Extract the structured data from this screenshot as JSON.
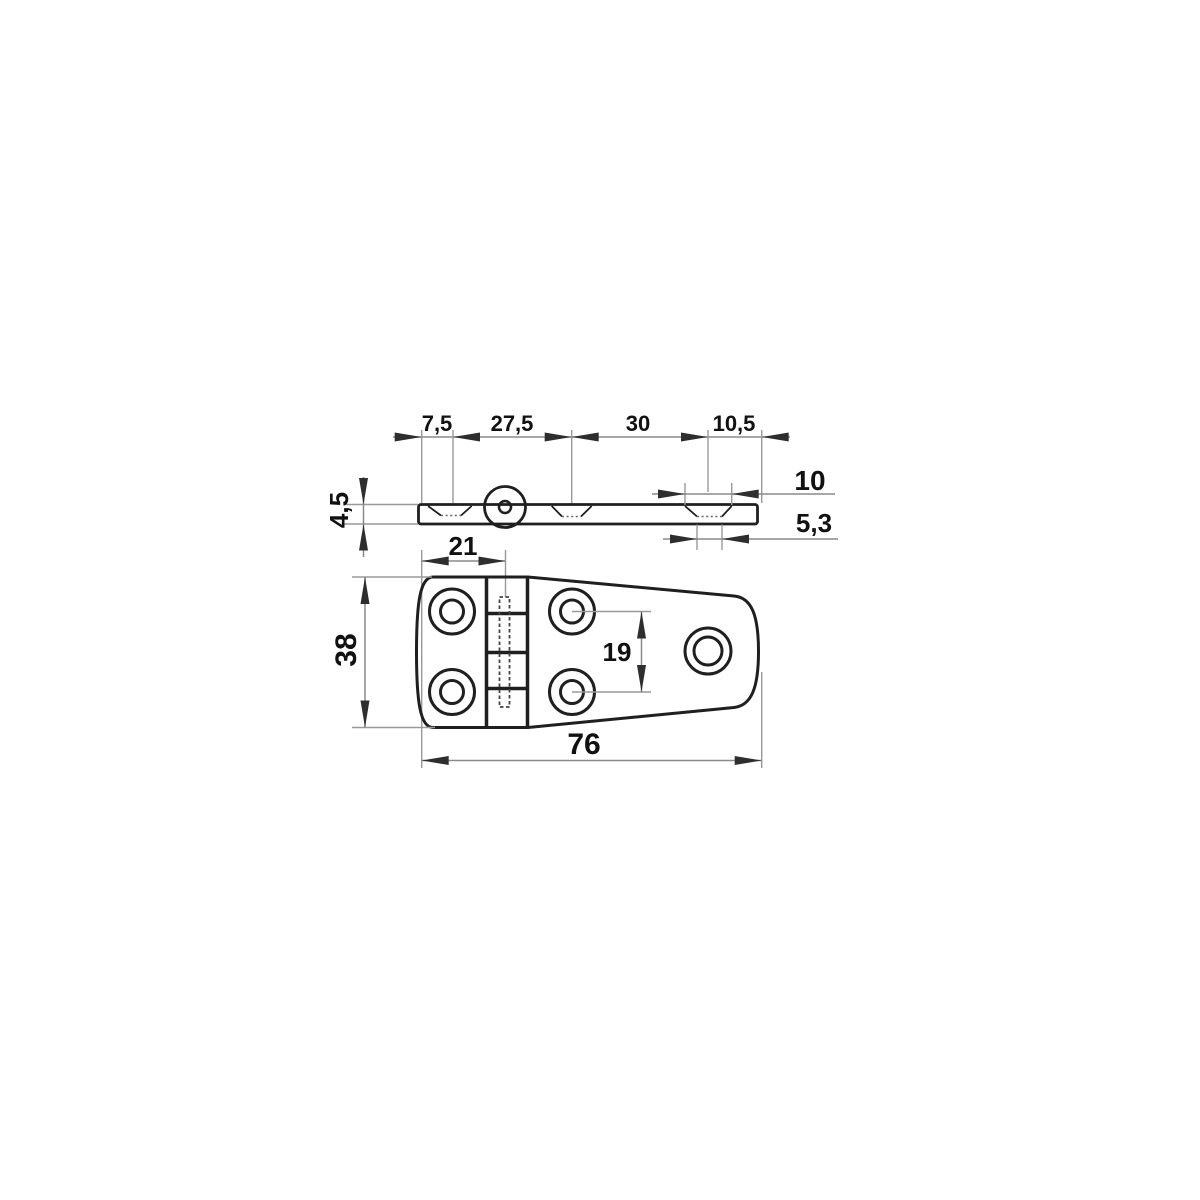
{
  "colors": {
    "background": "#ffffff",
    "object_line": "#1f1f1f",
    "dimension_line": "#8a8a8a",
    "extension_line": "#999999",
    "text": "#111111"
  },
  "side_view": {
    "chain_dims": [
      "7,5",
      "27,5",
      "30",
      "10,5"
    ],
    "thickness": "4,5",
    "countersink_width": "10",
    "hole_width": "5,3"
  },
  "plan_view": {
    "leaf_width": "21",
    "plate_height": "38",
    "hole_spacing": "19",
    "plate_length": "76"
  }
}
